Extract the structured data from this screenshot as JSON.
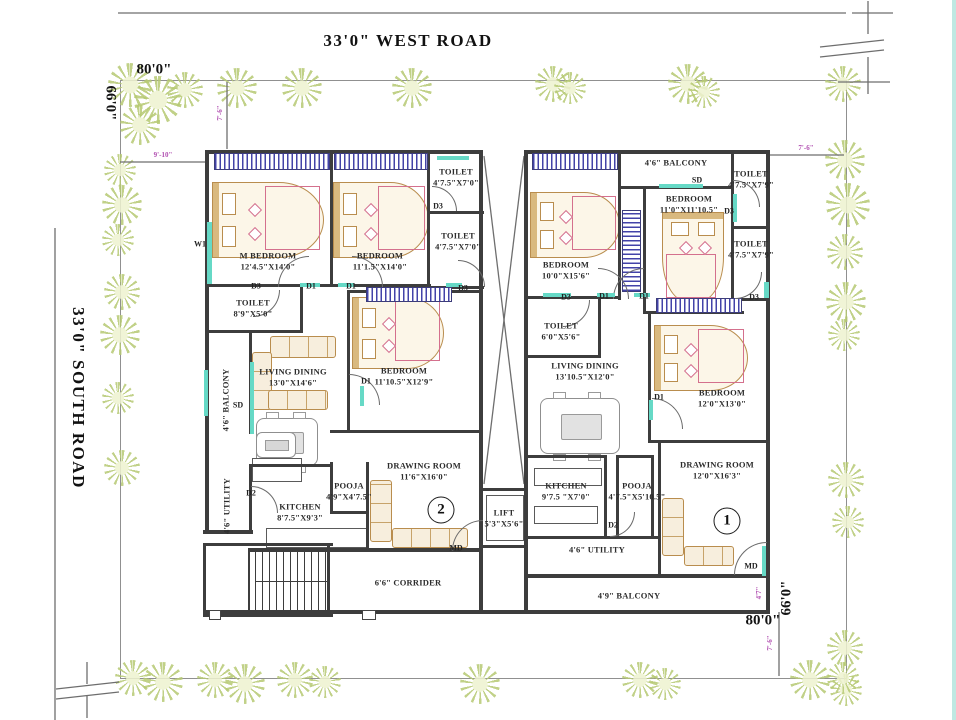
{
  "roads": {
    "west": "33'0\"  WEST ROAD",
    "south": "33'0\"  SOUTH ROAD"
  },
  "plot": {
    "top_width": "80'0\"",
    "left_height": "66'0\"",
    "bottom_width": "80'0\"",
    "right_height": "66'0\""
  },
  "colors": {
    "wall": "#3d3d3d",
    "window_blue": "#4343a8",
    "teal": "#66d9c6",
    "tree_green": "#b7ca74",
    "dim_pink": "#b14fb1"
  },
  "units": [
    {
      "n": "2",
      "x": 441,
      "y": 510
    },
    {
      "n": "1",
      "x": 727,
      "y": 521
    }
  ],
  "plan": {
    "walls": [
      [
        205,
        150,
        278,
        4
      ],
      [
        524,
        150,
        246,
        4
      ],
      [
        205,
        150,
        4,
        384
      ],
      [
        766,
        150,
        4,
        464
      ],
      [
        479,
        152,
        4,
        340
      ],
      [
        524,
        152,
        4,
        460
      ],
      [
        330,
        154,
        3,
        132
      ],
      [
        427,
        154,
        3,
        134
      ],
      [
        427,
        211,
        57,
        3
      ],
      [
        427,
        286,
        57,
        3
      ],
      [
        205,
        284,
        226,
        3
      ],
      [
        205,
        330,
        98,
        3
      ],
      [
        300,
        287,
        3,
        45
      ],
      [
        249,
        332,
        3,
        102
      ],
      [
        249,
        464,
        3,
        70
      ],
      [
        203,
        530,
        50,
        4
      ],
      [
        347,
        290,
        3,
        142
      ],
      [
        347,
        290,
        135,
        3
      ],
      [
        330,
        430,
        152,
        3
      ],
      [
        330,
        462,
        3,
        52
      ],
      [
        366,
        462,
        3,
        88
      ],
      [
        332,
        511,
        36,
        3
      ],
      [
        249,
        464,
        84,
        3
      ],
      [
        249,
        548,
        234,
        4
      ],
      [
        203,
        610,
        567,
        4
      ],
      [
        203,
        543,
        130,
        3
      ],
      [
        203,
        614,
        130,
        3
      ],
      [
        203,
        543,
        3,
        74
      ],
      [
        327,
        543,
        3,
        74
      ],
      [
        248,
        548,
        2,
        64
      ],
      [
        479,
        488,
        49,
        3
      ],
      [
        479,
        545,
        49,
        3
      ],
      [
        479,
        488,
        4,
        124
      ],
      [
        618,
        150,
        3,
        150
      ],
      [
        527,
        296,
        93,
        3
      ],
      [
        620,
        186,
        113,
        3
      ],
      [
        731,
        150,
        3,
        150
      ],
      [
        731,
        226,
        38,
        3
      ],
      [
        731,
        298,
        38,
        3
      ],
      [
        643,
        188,
        3,
        126
      ],
      [
        643,
        311,
        101,
        3
      ],
      [
        598,
        298,
        3,
        60
      ],
      [
        527,
        355,
        74,
        3
      ],
      [
        648,
        311,
        3,
        131
      ],
      [
        648,
        440,
        120,
        3
      ],
      [
        527,
        455,
        80,
        3
      ],
      [
        604,
        455,
        3,
        83
      ],
      [
        616,
        455,
        3,
        83
      ],
      [
        651,
        455,
        3,
        83
      ],
      [
        616,
        455,
        38,
        3
      ],
      [
        527,
        536,
        134,
        3
      ],
      [
        658,
        440,
        3,
        136
      ],
      [
        527,
        574,
        242,
        4
      ]
    ],
    "windows": [
      [
        214,
        153,
        114,
        15,
        "h"
      ],
      [
        334,
        153,
        92,
        15,
        "h"
      ],
      [
        532,
        153,
        84,
        15,
        "h"
      ],
      [
        366,
        287,
        84,
        13,
        "h"
      ],
      [
        656,
        298,
        84,
        13,
        "h"
      ],
      [
        622,
        210,
        17,
        80,
        "v"
      ]
    ],
    "teal": [
      [
        207,
        222,
        5,
        62
      ],
      [
        250,
        362,
        4,
        72
      ],
      [
        437,
        156,
        32,
        4
      ],
      [
        659,
        184,
        44,
        4
      ],
      [
        733,
        194,
        4,
        28
      ],
      [
        543,
        293,
        28,
        4
      ],
      [
        762,
        546,
        4,
        30
      ],
      [
        300,
        283,
        20,
        4
      ],
      [
        338,
        283,
        16,
        4
      ],
      [
        597,
        293,
        18,
        4
      ],
      [
        634,
        293,
        16,
        4
      ],
      [
        649,
        400,
        4,
        20
      ],
      [
        360,
        386,
        4,
        20
      ],
      [
        446,
        283,
        16,
        4
      ],
      [
        204,
        370,
        4,
        46
      ],
      [
        764,
        282,
        5,
        16
      ]
    ],
    "posts": [
      [
        209,
        610,
        10,
        8
      ],
      [
        362,
        610,
        12,
        8
      ]
    ],
    "rooms": [
      {
        "n": "M BEDROOM",
        "d": "12'4.5\"X14'0\"",
        "x": 268,
        "y": 261
      },
      {
        "n": "BEDROOM",
        "d": "11'1.5\"X14'0\"",
        "x": 380,
        "y": 261
      },
      {
        "n": "TOILET",
        "d": "4'7.5\"X7'0\"",
        "x": 456,
        "y": 177
      },
      {
        "n": "TOILET",
        "d": "4'7.5\"X7'0\"",
        "x": 458,
        "y": 241
      },
      {
        "n": "TOILET",
        "d": "8'9\"X5'0\"",
        "x": 253,
        "y": 308
      },
      {
        "n": "4'6\" BALCONY",
        "d": "",
        "x": 226,
        "y": 400,
        "v": 1
      },
      {
        "n": "LIVING DINING",
        "d": "13'0\"X14'6\"",
        "x": 293,
        "y": 377
      },
      {
        "n": "BEDROOM",
        "d": "11'10.5\"X12'9\"",
        "x": 404,
        "y": 376
      },
      {
        "n": "4'6\" UTILITY",
        "d": "",
        "x": 227,
        "y": 506,
        "v": 1
      },
      {
        "n": "KITCHEN",
        "d": "8'7.5\"X9'3\"",
        "x": 300,
        "y": 512
      },
      {
        "n": "POOJA",
        "d": "4'9\"X4'7.5\"",
        "x": 349,
        "y": 491
      },
      {
        "n": "DRAWING ROOM",
        "d": "11'6\"X16'0\"",
        "x": 424,
        "y": 471
      },
      {
        "n": "LIFT",
        "d": "5'3\"X5'6\"",
        "x": 504,
        "y": 518
      },
      {
        "n": "6'6\" CORRIDER",
        "d": "",
        "x": 408,
        "y": 583
      },
      {
        "n": "BEDROOM",
        "d": "10'0\"X15'6\"",
        "x": 566,
        "y": 270
      },
      {
        "n": "4'6\" BALCONY",
        "d": "",
        "x": 676,
        "y": 163
      },
      {
        "n": "BEDROOM",
        "d": "11'0\"X11'10.5\"",
        "x": 689,
        "y": 204
      },
      {
        "n": "TOILET",
        "d": "4'7.5\"X7'9\"",
        "x": 751,
        "y": 179
      },
      {
        "n": "TOILET",
        "d": "4'7.5\"X7'9\"",
        "x": 751,
        "y": 249
      },
      {
        "n": "TOILET",
        "d": "6'0\"X5'6\"",
        "x": 561,
        "y": 331
      },
      {
        "n": "LIVING DINING",
        "d": "13'10.5\"X12'0\"",
        "x": 585,
        "y": 371
      },
      {
        "n": "BEDROOM",
        "d": "12'0\"X13'0\"",
        "x": 722,
        "y": 398
      },
      {
        "n": "KITCHEN",
        "d": "9'7.5 \"X7'0\"",
        "x": 566,
        "y": 491
      },
      {
        "n": "POOJA",
        "d": "4'7.5\"X5'10.5\"",
        "x": 637,
        "y": 491
      },
      {
        "n": "4'6\" UTILITY",
        "d": "",
        "x": 597,
        "y": 550
      },
      {
        "n": "DRAWING ROOM",
        "d": "12'0\"X16'3\"",
        "x": 717,
        "y": 470
      },
      {
        "n": "4'9\" BALCONY",
        "d": "",
        "x": 629,
        "y": 596
      }
    ],
    "door_labels": [
      {
        "t": "D3",
        "x": 256,
        "y": 286
      },
      {
        "t": "D1",
        "x": 311,
        "y": 286
      },
      {
        "t": "D1",
        "x": 351,
        "y": 286
      },
      {
        "t": "D3",
        "x": 438,
        "y": 206
      },
      {
        "t": "D3",
        "x": 463,
        "y": 288
      },
      {
        "t": "D1",
        "x": 366,
        "y": 381
      },
      {
        "t": "D2",
        "x": 251,
        "y": 493
      },
      {
        "t": "W1",
        "x": 200,
        "y": 244
      },
      {
        "t": "SD",
        "x": 238,
        "y": 405
      },
      {
        "t": "MD",
        "x": 456,
        "y": 548
      },
      {
        "t": "D3",
        "x": 566,
        "y": 297
      },
      {
        "t": "D1",
        "x": 604,
        "y": 296
      },
      {
        "t": "D1",
        "x": 644,
        "y": 296
      },
      {
        "t": "D3",
        "x": 729,
        "y": 211
      },
      {
        "t": "D3",
        "x": 754,
        "y": 297
      },
      {
        "t": "D1",
        "x": 659,
        "y": 397
      },
      {
        "t": "D2",
        "x": 613,
        "y": 525
      },
      {
        "t": "SD",
        "x": 697,
        "y": 180
      },
      {
        "t": "MD",
        "x": 751,
        "y": 566
      }
    ],
    "dim_labels": [
      {
        "t": "7'-6\"",
        "x": 220,
        "y": 113,
        "r": 1
      },
      {
        "t": "9'-10\"",
        "x": 163,
        "y": 155,
        "r": 0
      },
      {
        "t": "7'-6\"",
        "x": 806,
        "y": 148,
        "r": 0
      },
      {
        "t": "7'-6\"",
        "x": 770,
        "y": 643,
        "r": 1
      },
      {
        "t": "4'7\"",
        "x": 759,
        "y": 593,
        "r": 1
      }
    ],
    "arcs": [
      [
        278,
        256,
        30,
        "tl"
      ],
      [
        352,
        256,
        30,
        "tr"
      ],
      [
        349,
        374,
        30,
        "tr"
      ],
      [
        432,
        186,
        24,
        "tr"
      ],
      [
        458,
        260,
        26,
        "tr"
      ],
      [
        253,
        290,
        26,
        "br"
      ],
      [
        452,
        520,
        30,
        "tl"
      ],
      [
        251,
        486,
        26,
        "tr"
      ],
      [
        598,
        268,
        30,
        "tr"
      ],
      [
        613,
        268,
        30,
        "tl"
      ],
      [
        652,
        398,
        30,
        "tr"
      ],
      [
        733,
        180,
        26,
        "tr"
      ],
      [
        735,
        272,
        26,
        "br"
      ],
      [
        563,
        300,
        26,
        "br"
      ],
      [
        734,
        542,
        32,
        "tl"
      ],
      [
        610,
        512,
        24,
        "br"
      ]
    ],
    "beds": [
      {
        "x": 212,
        "y": 182,
        "w": 110,
        "h": 74,
        "o": "h"
      },
      {
        "x": 333,
        "y": 182,
        "w": 94,
        "h": 74,
        "o": "h"
      },
      {
        "x": 352,
        "y": 297,
        "w": 90,
        "h": 70,
        "o": "h"
      },
      {
        "x": 530,
        "y": 192,
        "w": 88,
        "h": 64,
        "o": "h"
      },
      {
        "x": 662,
        "y": 212,
        "w": 60,
        "h": 88,
        "o": "v"
      },
      {
        "x": 654,
        "y": 325,
        "w": 92,
        "h": 64,
        "o": "h"
      }
    ],
    "sofas": [
      {
        "x": 270,
        "y": 336,
        "w": 64,
        "h": 20,
        "o": "h"
      },
      {
        "x": 252,
        "y": 352,
        "w": 18,
        "h": 56,
        "o": "v"
      },
      {
        "x": 268,
        "y": 390,
        "w": 58,
        "h": 18,
        "o": "h"
      },
      {
        "x": 370,
        "y": 480,
        "w": 20,
        "h": 60,
        "o": "v"
      },
      {
        "x": 392,
        "y": 528,
        "w": 74,
        "h": 18,
        "o": "h"
      },
      {
        "x": 662,
        "y": 498,
        "w": 20,
        "h": 56,
        "o": "v"
      },
      {
        "x": 684,
        "y": 546,
        "w": 48,
        "h": 18,
        "o": "h"
      }
    ],
    "dinings": [
      {
        "x": 256,
        "y": 418,
        "w": 60,
        "h": 46
      },
      {
        "x": 540,
        "y": 398,
        "w": 78,
        "h": 54
      }
    ],
    "counters": [
      {
        "x": 252,
        "y": 458,
        "w": 48,
        "h": 22
      },
      {
        "x": 266,
        "y": 528,
        "w": 100,
        "h": 18
      },
      {
        "x": 534,
        "y": 468,
        "w": 66,
        "h": 16
      },
      {
        "x": 534,
        "y": 506,
        "w": 62,
        "h": 16
      },
      {
        "x": 486,
        "y": 495,
        "w": 36,
        "h": 44
      }
    ],
    "tvs": [
      {
        "x": 256,
        "y": 432,
        "w": 38,
        "h": 24
      }
    ],
    "stairs": {
      "x1": 255,
      "x2": 325,
      "step": 7,
      "y1": 550,
      "y2": 612,
      "mid_y": 581
    },
    "trees": [
      [
        130,
        85,
        22
      ],
      [
        158,
        100,
        24
      ],
      [
        140,
        125,
        20
      ],
      [
        185,
        90,
        18
      ],
      [
        237,
        88,
        20
      ],
      [
        302,
        88,
        20
      ],
      [
        412,
        88,
        20
      ],
      [
        553,
        84,
        18
      ],
      [
        570,
        88,
        16
      ],
      [
        688,
        84,
        20
      ],
      [
        704,
        92,
        16
      ],
      [
        843,
        84,
        18
      ],
      [
        120,
        170,
        16
      ],
      [
        122,
        205,
        20
      ],
      [
        118,
        240,
        16
      ],
      [
        122,
        292,
        18
      ],
      [
        120,
        335,
        20
      ],
      [
        118,
        398,
        16
      ],
      [
        122,
        468,
        18
      ],
      [
        845,
        160,
        20
      ],
      [
        848,
        205,
        22
      ],
      [
        845,
        252,
        18
      ],
      [
        846,
        302,
        20
      ],
      [
        844,
        335,
        16
      ],
      [
        846,
        480,
        18
      ],
      [
        848,
        522,
        16
      ],
      [
        845,
        648,
        18
      ],
      [
        846,
        690,
        16
      ],
      [
        133,
        678,
        18
      ],
      [
        163,
        682,
        20
      ],
      [
        215,
        680,
        18
      ],
      [
        245,
        684,
        20
      ],
      [
        295,
        680,
        18
      ],
      [
        325,
        682,
        16
      ],
      [
        480,
        684,
        20
      ],
      [
        640,
        680,
        18
      ],
      [
        665,
        684,
        16
      ],
      [
        810,
        680,
        20
      ],
      [
        843,
        678,
        16
      ]
    ],
    "svg_lines": [
      [
        484,
        156,
        524,
        484
      ],
      [
        524,
        156,
        484,
        484
      ],
      [
        118,
        13,
        846,
        13
      ],
      [
        852,
        13,
        893,
        13
      ],
      [
        868,
        1,
        868,
        34
      ],
      [
        820,
        47,
        884,
        40
      ],
      [
        820,
        57,
        884,
        50
      ],
      [
        868,
        57,
        868,
        94
      ],
      [
        838,
        82,
        890,
        82
      ],
      [
        55,
        228,
        55,
        720
      ],
      [
        87,
        662,
        87,
        684
      ],
      [
        56,
        689,
        119,
        682
      ],
      [
        56,
        699,
        119,
        692
      ],
      [
        87,
        696,
        87,
        718
      ],
      [
        120,
        162,
        205,
        162
      ],
      [
        770,
        155,
        844,
        155
      ],
      [
        779,
        612,
        779,
        676
      ],
      [
        227,
        82,
        227,
        149
      ]
    ],
    "plot_rect": {
      "x": 120,
      "y": 80,
      "w": 725,
      "h": 597
    }
  }
}
